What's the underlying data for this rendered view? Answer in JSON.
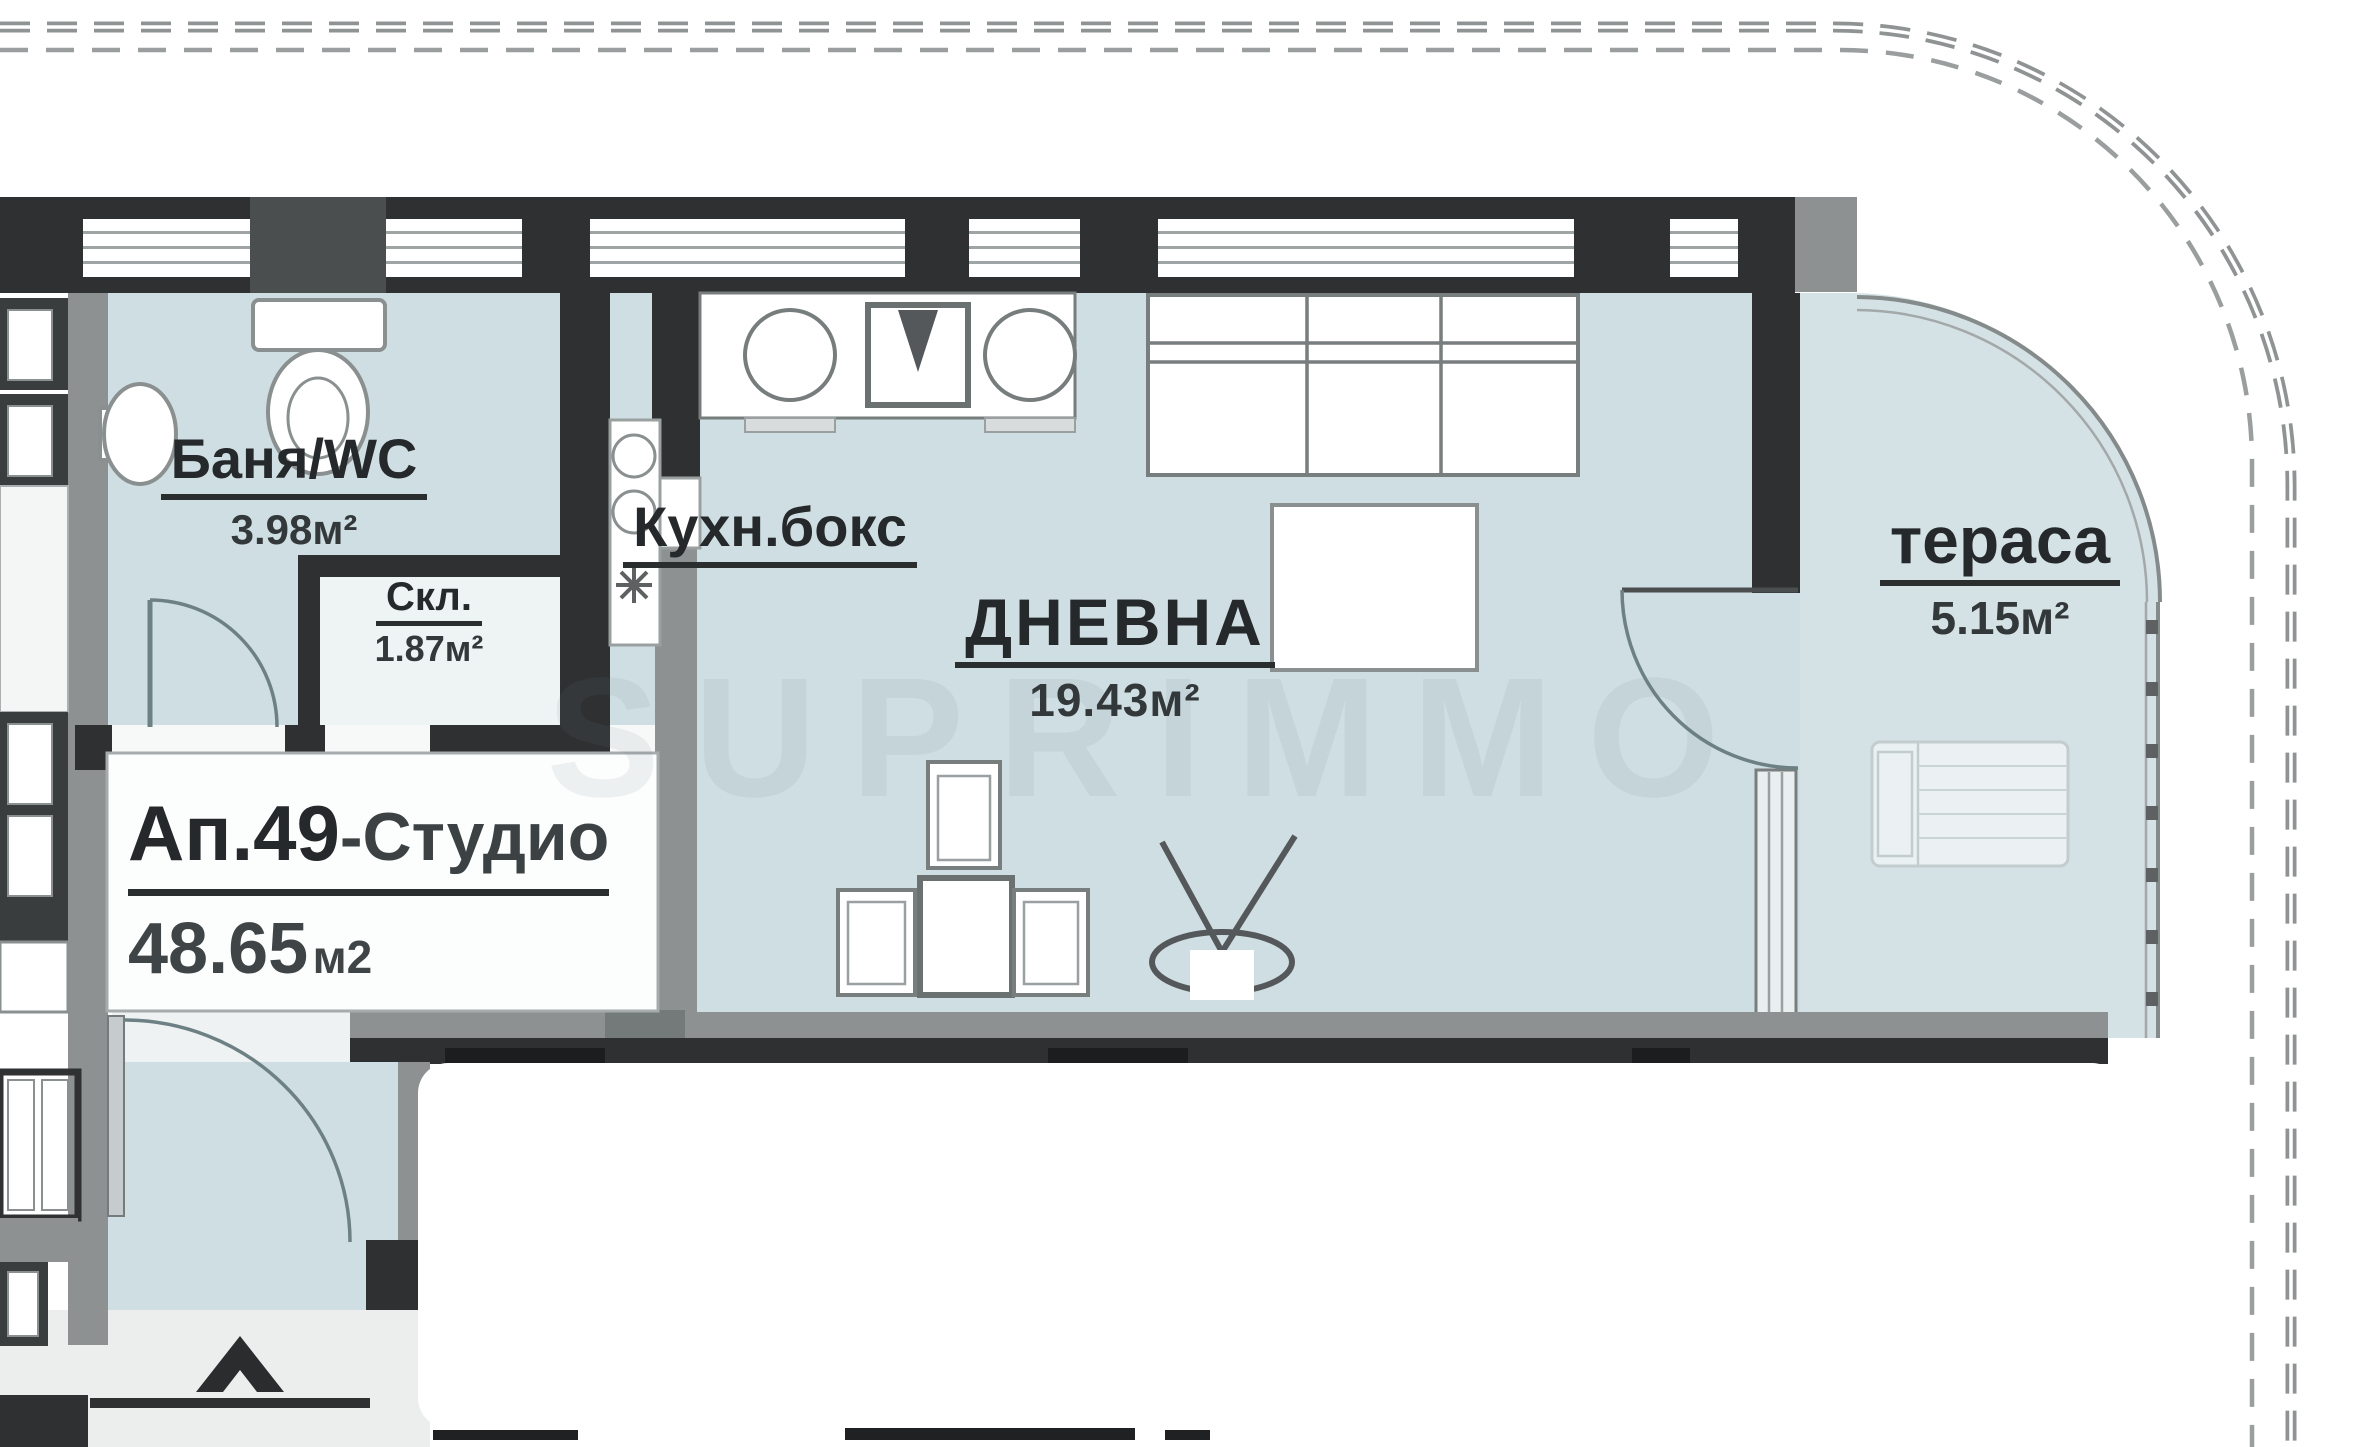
{
  "plan": {
    "rooms": {
      "bathroom": {
        "name": "Баня/WC",
        "area": "3.98м²"
      },
      "storage": {
        "name": "Скл.",
        "area": "1.87м²"
      },
      "kitchen": {
        "name": "Кухн.бокс"
      },
      "living": {
        "name": "ДНЕВНА",
        "area": "19.43м²"
      },
      "terrace": {
        "name": "тераса",
        "area": "5.15м²"
      }
    },
    "apartment": {
      "number": "Ап.49",
      "type_suffix": "-Студио",
      "area_value": "48.65",
      "area_unit": "м2"
    },
    "watermark": "SUPRIMMO",
    "colors": {
      "wall_dark": "#2e3031",
      "wall_gray": "#8d9192",
      "floor": "#cfdee2",
      "terrace_floor": "#d4e1e5",
      "line_gray": "#787d7e",
      "dashed_line": "#8f9394",
      "outside": "#eceeee",
      "text": "#26292b"
    }
  }
}
